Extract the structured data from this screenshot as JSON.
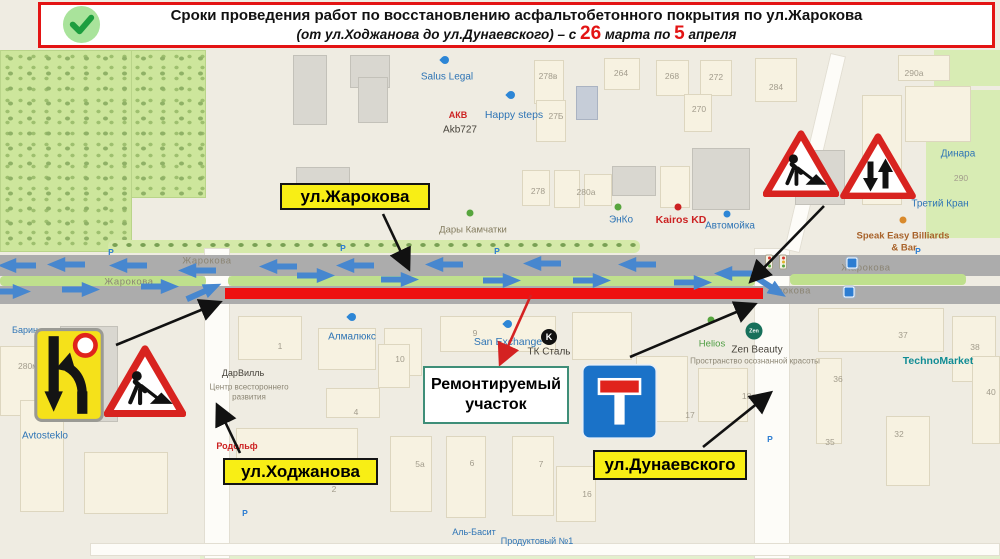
{
  "header": {
    "line1": "Сроки проведения работ по восстановлению асфальтобетонного покрытия по ул.Жарокова",
    "line2_prefix": "(от ул.Ходжанова до ул.Дунаевского) – с ",
    "date_start": "26",
    "line2_mid": " марта по ",
    "date_end": "5",
    "line2_suffix": " апреля"
  },
  "legend_boxes": {
    "zharokova": "ул.Жарокова",
    "khodzhanova": "ул.Ходжанова",
    "dunaevskogo": "ул.Дунаевского",
    "repair_line1": "Ремонтируемый",
    "repair_line2": "участок"
  },
  "colors": {
    "header_red": "#e31414",
    "repair_red": "#ee1111",
    "label_yellow": "#f8ee15",
    "arrow_blue": "#4787cf",
    "sign_red": "#d8231f",
    "deadend_blue": "#1a72c8",
    "detour_yellow": "#f5e11a"
  },
  "map": {
    "street_labels": [
      [
        "Жарокова",
        207,
        261
      ],
      [
        "Жарокова",
        129,
        282
      ],
      [
        "Жарокова",
        866,
        268
      ],
      [
        "рокова",
        794,
        291
      ]
    ],
    "poi_labels": [
      [
        "Salus Legal",
        447,
        77,
        "blue",
        10
      ],
      [
        "АКВ",
        458,
        115,
        "red",
        9
      ],
      [
        "Akb727",
        460,
        130,
        "dark",
        10
      ],
      [
        "Happy steps",
        514,
        115,
        "blue",
        10.5
      ],
      [
        "Дары Камчатки",
        473,
        230,
        "olive",
        9.5
      ],
      [
        "ЭнКо",
        621,
        220,
        "blue",
        10
      ],
      [
        "Kairos KD",
        681,
        220,
        "red",
        10.5
      ],
      [
        "Автомойка",
        730,
        226,
        "blue",
        10
      ],
      [
        "Динара",
        958,
        154,
        "blue",
        10
      ],
      [
        "Третий Кран",
        940,
        204,
        "blue",
        10
      ],
      [
        "Speak Easy Billiards",
        903,
        236,
        "brown",
        9.5
      ],
      [
        "& Bar",
        904,
        248,
        "brown",
        9.5
      ],
      [
        "Барин",
        25,
        330,
        "blue",
        9
      ],
      [
        "Avtosteklo",
        45,
        436,
        "blue",
        10
      ],
      [
        "ДарВилль",
        243,
        373,
        "dark",
        9
      ],
      [
        "Центр всестороннего",
        249,
        387,
        "gray",
        8
      ],
      [
        "развития",
        249,
        397,
        "gray",
        8
      ],
      [
        "Родольф",
        237,
        446,
        "red",
        9
      ],
      [
        "Алмалюкс",
        352,
        337,
        "blue",
        10
      ],
      [
        "San Exchange",
        508,
        342,
        "blue",
        10.5
      ],
      [
        "ТК Сталь",
        549,
        352,
        "dark",
        10
      ],
      [
        "Helios",
        712,
        344,
        "green",
        9.5
      ],
      [
        "Zen Beauty",
        757,
        350,
        "dark",
        10
      ],
      [
        "Пространство осознанной красоты",
        755,
        361,
        "gray",
        8
      ],
      [
        "TechnoMarket",
        938,
        361,
        "teal",
        10.5
      ],
      [
        "Аль-Басит",
        474,
        532,
        "blue",
        9
      ],
      [
        "Продуктовый №1",
        537,
        541,
        "blue",
        9
      ]
    ],
    "building_numbers": [
      [
        "278в",
        548,
        76
      ],
      [
        "264",
        621,
        73
      ],
      [
        "268",
        672,
        76
      ],
      [
        "272",
        716,
        77
      ],
      [
        "27Б",
        556,
        116
      ],
      [
        "270",
        699,
        109
      ],
      [
        "278",
        538,
        191
      ],
      [
        "280а",
        586,
        192
      ],
      [
        "284",
        776,
        87
      ],
      [
        "290а",
        914,
        73
      ],
      [
        "290",
        961,
        178
      ],
      [
        "280м",
        28,
        366
      ],
      [
        "37",
        903,
        335
      ],
      [
        "38",
        975,
        347
      ],
      [
        "36",
        838,
        379
      ],
      [
        "35",
        830,
        442
      ],
      [
        "40",
        991,
        392
      ],
      [
        "32",
        899,
        434
      ],
      [
        "17",
        690,
        415
      ],
      [
        "18а",
        749,
        396
      ],
      [
        "16",
        587,
        494
      ],
      [
        "5а",
        420,
        464
      ],
      [
        "6",
        472,
        463
      ],
      [
        "7",
        541,
        464
      ],
      [
        "9",
        475,
        333
      ],
      [
        "10",
        400,
        359
      ],
      [
        "4",
        356,
        412
      ],
      [
        "1",
        280,
        346
      ],
      [
        "2",
        334,
        489
      ]
    ],
    "greens": [
      [
        0,
        50,
        206,
        148,
        "park"
      ],
      [
        0,
        50,
        132,
        202,
        "park"
      ],
      [
        108,
        240,
        532,
        13,
        "trees"
      ],
      [
        926,
        90,
        74,
        148,
        "lawn"
      ],
      [
        934,
        50,
        66,
        36,
        "lawn"
      ],
      [
        200,
        548,
        800,
        11,
        "lawn-light"
      ]
    ],
    "streets": [
      [
        204,
        248,
        26,
        311
      ],
      [
        754,
        248,
        36,
        311
      ],
      [
        90,
        543,
        910,
        13
      ]
    ],
    "diagonal_street": {
      "left": 807,
      "top": 52,
      "width": 16,
      "height": 202,
      "angle": 13.3
    },
    "buildings": [
      [
        293,
        55,
        34,
        70,
        "g"
      ],
      [
        350,
        55,
        40,
        33,
        "g"
      ],
      [
        358,
        77,
        30,
        46,
        "g"
      ],
      [
        296,
        167,
        54,
        19,
        "g"
      ],
      [
        534,
        60,
        30,
        44,
        "c"
      ],
      [
        604,
        58,
        36,
        32,
        "c"
      ],
      [
        656,
        60,
        33,
        36,
        "c"
      ],
      [
        700,
        60,
        32,
        36,
        "c"
      ],
      [
        576,
        86,
        22,
        34,
        "b"
      ],
      [
        536,
        100,
        30,
        42,
        "c"
      ],
      [
        684,
        94,
        28,
        38,
        "c"
      ],
      [
        522,
        170,
        28,
        36,
        "c"
      ],
      [
        554,
        170,
        26,
        38,
        "c"
      ],
      [
        584,
        174,
        28,
        32,
        "c"
      ],
      [
        612,
        166,
        44,
        30,
        "g"
      ],
      [
        660,
        166,
        30,
        42,
        "c"
      ],
      [
        692,
        148,
        58,
        62,
        "g"
      ],
      [
        755,
        58,
        42,
        44,
        "c"
      ],
      [
        795,
        150,
        50,
        55,
        "g"
      ],
      [
        862,
        95,
        40,
        110,
        "c"
      ],
      [
        898,
        55,
        52,
        26,
        "c"
      ],
      [
        905,
        86,
        66,
        56,
        "c"
      ],
      [
        238,
        316,
        64,
        44,
        "c"
      ],
      [
        318,
        328,
        58,
        42,
        "c"
      ],
      [
        384,
        328,
        38,
        48,
        "c"
      ],
      [
        440,
        316,
        116,
        36,
        "c"
      ],
      [
        378,
        344,
        32,
        44,
        "c"
      ],
      [
        326,
        388,
        54,
        30,
        "c"
      ],
      [
        236,
        428,
        122,
        38,
        "c"
      ],
      [
        572,
        312,
        60,
        48,
        "c"
      ],
      [
        636,
        356,
        52,
        66,
        "c"
      ],
      [
        698,
        368,
        50,
        54,
        "c"
      ],
      [
        818,
        308,
        126,
        44,
        "c"
      ],
      [
        952,
        316,
        44,
        66,
        "c"
      ],
      [
        816,
        358,
        26,
        86,
        "c"
      ],
      [
        886,
        416,
        44,
        70,
        "c"
      ],
      [
        972,
        356,
        28,
        88,
        "c"
      ],
      [
        390,
        436,
        42,
        76,
        "c"
      ],
      [
        446,
        436,
        40,
        82,
        "c"
      ],
      [
        512,
        436,
        42,
        80,
        "c"
      ],
      [
        556,
        466,
        40,
        56,
        "c"
      ],
      [
        60,
        326,
        58,
        96,
        "g"
      ],
      [
        84,
        452,
        84,
        62,
        "c"
      ],
      [
        0,
        346,
        40,
        70,
        "c"
      ],
      [
        20,
        400,
        44,
        112,
        "c"
      ]
    ],
    "road": {
      "upper": [
        0,
        255,
        1000,
        21
      ],
      "lower": [
        0,
        286,
        1000,
        18
      ],
      "medians": [
        [
          0,
          276,
          206,
          10
        ],
        [
          228,
          276,
          527,
          10
        ],
        [
          790,
          274,
          176,
          11
        ]
      ]
    },
    "red_line": [
      225,
      288,
      538,
      11
    ],
    "arrows": [
      [
        17,
        266,
        180
      ],
      [
        66,
        265,
        180
      ],
      [
        128,
        266,
        180
      ],
      [
        197,
        271,
        180
      ],
      [
        278,
        267,
        180
      ],
      [
        355,
        266,
        180
      ],
      [
        444,
        265,
        180
      ],
      [
        542,
        264,
        180
      ],
      [
        637,
        265,
        180
      ],
      [
        733,
        274,
        180
      ],
      [
        12,
        292,
        0
      ],
      [
        81,
        290,
        0
      ],
      [
        160,
        287,
        0
      ],
      [
        204,
        292,
        -24
      ],
      [
        316,
        276,
        0
      ],
      [
        400,
        280,
        0
      ],
      [
        502,
        281,
        0
      ],
      [
        592,
        281,
        0
      ],
      [
        693,
        283,
        0
      ],
      [
        770,
        287,
        33
      ]
    ],
    "annotation_lines": [
      [
        383,
        214,
        408,
        267,
        "k"
      ],
      [
        824,
        206,
        752,
        280,
        "k"
      ],
      [
        116,
        345,
        218,
        303,
        "k"
      ],
      [
        630,
        357,
        753,
        305,
        "k"
      ],
      [
        703,
        447,
        769,
        394,
        "k"
      ],
      [
        240,
        453,
        218,
        407,
        "k"
      ],
      [
        531,
        295,
        501,
        362,
        "r"
      ]
    ],
    "pins_blue": [
      [
        445,
        64
      ],
      [
        511,
        99
      ],
      [
        352,
        321
      ],
      [
        508,
        328
      ]
    ],
    "dots": [
      [
        618,
        207,
        "#57a53e"
      ],
      [
        470,
        213,
        "#57a53e"
      ],
      [
        711,
        320,
        "#57a53e"
      ],
      [
        874,
        190,
        "#57a53e"
      ],
      [
        727,
        214,
        "#2d86d6"
      ],
      [
        678,
        207,
        "#cc2222"
      ],
      [
        903,
        220,
        "#d98a2b"
      ]
    ],
    "p_marks": [
      [
        111,
        252
      ],
      [
        343,
        248
      ],
      [
        497,
        251
      ],
      [
        588,
        392
      ],
      [
        764,
        398
      ],
      [
        770,
        439
      ],
      [
        918,
        251
      ],
      [
        245,
        513
      ]
    ],
    "bus_stops": [
      [
        852,
        263
      ],
      [
        849,
        292
      ]
    ],
    "traffic_lights": [
      [
        769,
        262
      ],
      [
        783,
        262
      ]
    ],
    "logos": [
      [
        "K",
        549,
        337,
        16,
        "#111",
        9
      ],
      [
        "Zen",
        754,
        331,
        17,
        "#17705b",
        5.5
      ]
    ]
  }
}
